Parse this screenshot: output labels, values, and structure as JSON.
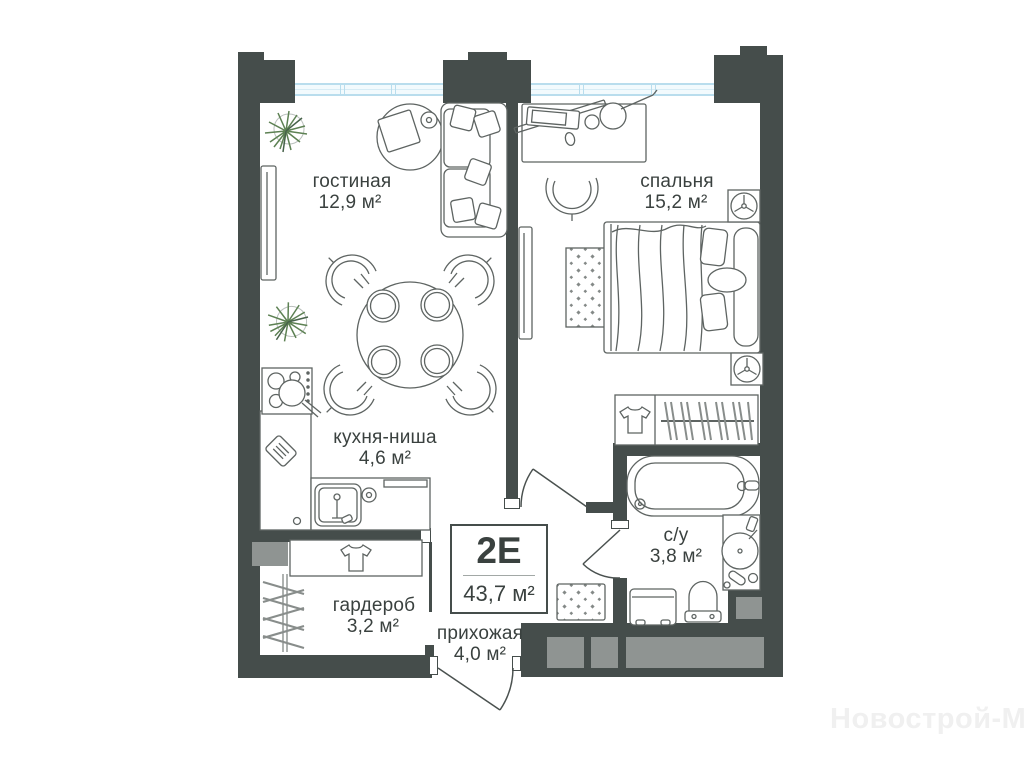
{
  "unit": {
    "label": "2Е",
    "total_area": "43,7 м²"
  },
  "rooms": [
    {
      "id": "living",
      "name": "гостиная",
      "area": "12,9 м²"
    },
    {
      "id": "bedroom",
      "name": "спальня",
      "area": "15,2 м²"
    },
    {
      "id": "kitchen",
      "name": "кухня-ниша",
      "area": "4,6 м²"
    },
    {
      "id": "wardrobe",
      "name": "гардероб",
      "area": "3,2 м²"
    },
    {
      "id": "hallway",
      "name": "прихожая",
      "area": "4,0 м²"
    },
    {
      "id": "bathroom",
      "name": "с/у",
      "area": "3,8 м²"
    }
  ],
  "watermark": "Новострой-М",
  "colors": {
    "wall": "#454d4b",
    "shaft_gray": "#8f9492",
    "window_blue": "#b9dded",
    "furniture_line": "#5e6462",
    "plant_green": "#5d8153",
    "text": "#3a413f",
    "watermark": "#f0f0f0"
  }
}
